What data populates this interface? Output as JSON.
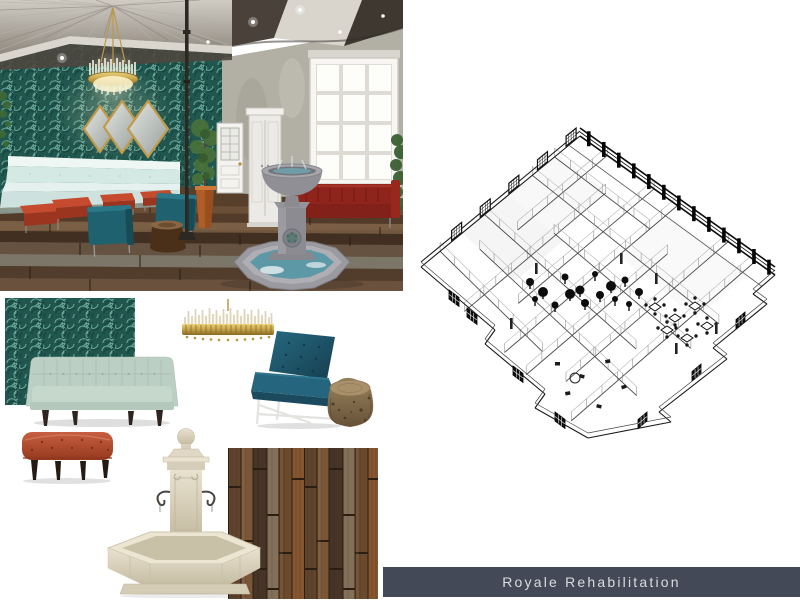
{
  "banner": {
    "title": "Royale Rehabilitation",
    "bg": "#434956",
    "fg": "#d9dbde"
  },
  "panels": {
    "lobby_render": {
      "name": "lobby-3d-render"
    },
    "floorplan": {
      "name": "isometric-wireframe-floorplan"
    }
  },
  "moodboard": {
    "items": [
      {
        "name": "teal-wallpaper-swatch",
        "color": "#20564e"
      },
      {
        "name": "mint-green-tufted-sofa",
        "color": "#bccfc5"
      },
      {
        "name": "gold-crystal-chandelier",
        "color": "#c9a84e"
      },
      {
        "name": "teal-accent-chair",
        "color": "#1d5a6e"
      },
      {
        "name": "tree-stump-side-table",
        "color": "#8a7455"
      },
      {
        "name": "rust-tufted-ottoman",
        "color": "#b5563c"
      },
      {
        "name": "stone-garden-fountain",
        "color": "#e3dcc9"
      },
      {
        "name": "rustic-wood-plank-flooring",
        "color": "#6b4c32"
      }
    ]
  },
  "palette": {
    "teal_wall": "#20564e",
    "teal_swirl": "#7fbfae",
    "petrol_blue": "#1e5a74",
    "rust_red": "#b5563c",
    "mint_seating": "#cfe5e1",
    "gold": "#c9a84e",
    "stone_gray": "#8f8f95",
    "water_blue": "#5d98a6",
    "concrete": "#b2afa5"
  }
}
